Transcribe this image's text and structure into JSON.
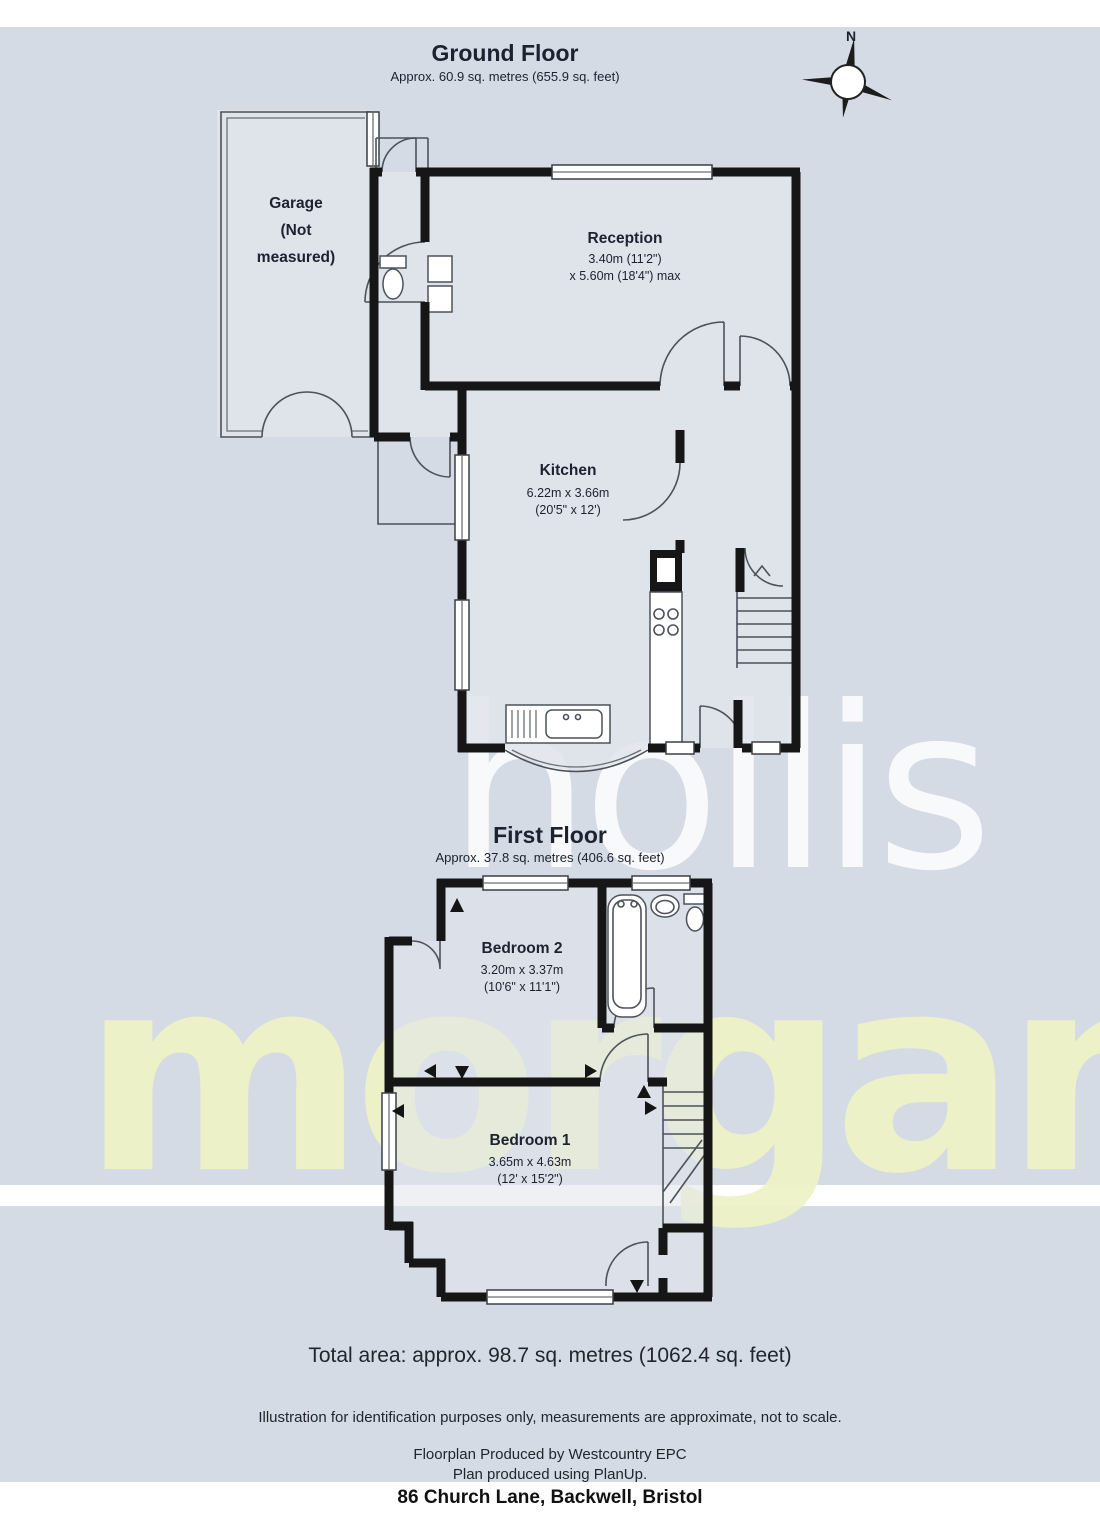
{
  "header": {
    "compass_label": "N"
  },
  "watermark": {
    "line1": "hollis",
    "line2": "morgan"
  },
  "colors": {
    "panel_background": "#d5dbe4",
    "wall": "#161616",
    "room_fill": "#e1e4eb",
    "watermark_hollis": "#ffffff",
    "watermark_morgan": "#eef3c6"
  },
  "ground_floor": {
    "title": "Ground Floor",
    "subtitle": "Approx.  60.9 sq. metres (655.9 sq. feet)",
    "garage": {
      "line1": "Garage",
      "line2": "(Not",
      "line3": "measured)"
    },
    "reception": {
      "name": "Reception",
      "dim1": "3.40m (11'2\")",
      "dim2": "x 5.60m (18'4\") max"
    },
    "kitchen": {
      "name": "Kitchen",
      "dim1": "6.22m x 3.66m",
      "dim2": "(20'5\" x 12')"
    }
  },
  "first_floor": {
    "title": "First Floor",
    "subtitle": "Approx.  37.8 sq. metres (406.6 sq. feet)",
    "bedroom2": {
      "name": "Bedroom 2",
      "dim1": "3.20m x 3.37m",
      "dim2": "(10'6\" x 11'1\")"
    },
    "bedroom1": {
      "name": "Bedroom 1",
      "dim1": "3.65m x 4.63m",
      "dim2": "(12' x 15'2\")"
    }
  },
  "footer": {
    "total_area": "Total area: approx.  98.7 sq. metres (1062.4 sq. feet)",
    "disclaimer": "Illustration for identification purposes only, measurements are approximate, not to scale.",
    "produced_by": "Floorplan Produced by Westcountry EPC",
    "produced_with": "Plan produced using PlanUp.",
    "address": "86 Church Lane, Backwell, Bristol"
  }
}
